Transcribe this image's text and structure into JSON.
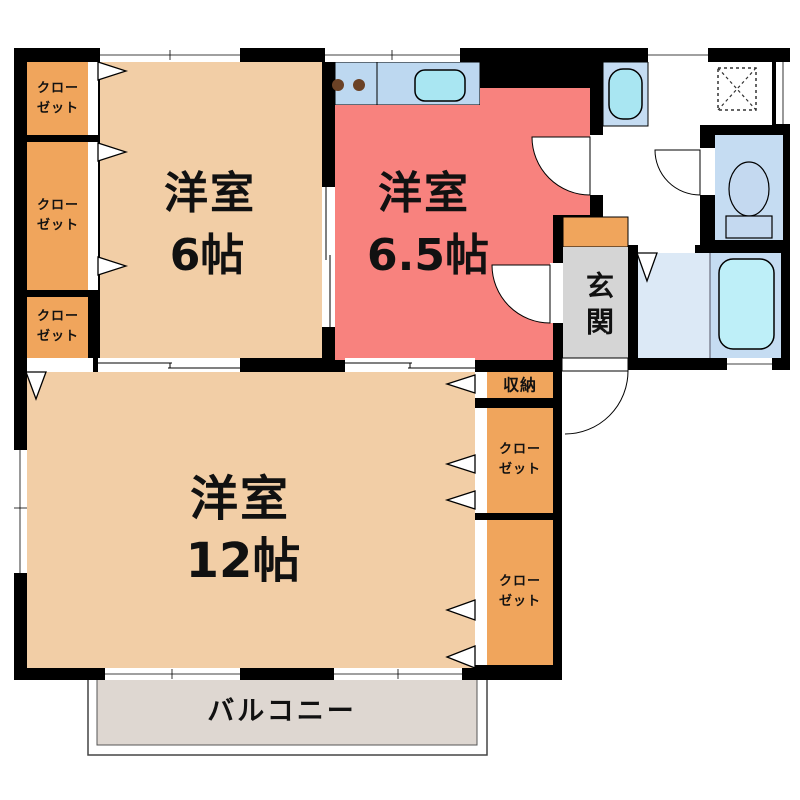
{
  "plan_type": "apartment-floor-plan",
  "rooms": {
    "bedroom6": {
      "name": "洋室",
      "size": "6帖"
    },
    "bedroom65": {
      "name": "洋室",
      "size": "6.5帖"
    },
    "bedroom12": {
      "name": "洋室",
      "size": "12帖"
    },
    "entrance": {
      "label": "玄関"
    },
    "balcony": {
      "label": "バルコニー"
    },
    "storage": {
      "label": "収納"
    },
    "closet": {
      "line1": "クロー",
      "line2": "ゼット"
    }
  },
  "colors": {
    "wall": "#000000",
    "room_peach": "#F2CEA6",
    "room_red": "#F8827E",
    "closet_orange": "#F0A55C",
    "counter_blue": "#BDD8F0",
    "fixture_cyan": "#A9E6F2",
    "tub_cyan": "#BEEFF8",
    "bath_blue": "#C5DCF2",
    "bath_blue_light": "#DCE9F6",
    "toilet_fixture": "#C4D9F0",
    "burner_brown": "#6B4226",
    "genkan_gray": "#D5D5D5",
    "balcony_gray": "#DED7D1",
    "white": "#FFFFFF"
  }
}
